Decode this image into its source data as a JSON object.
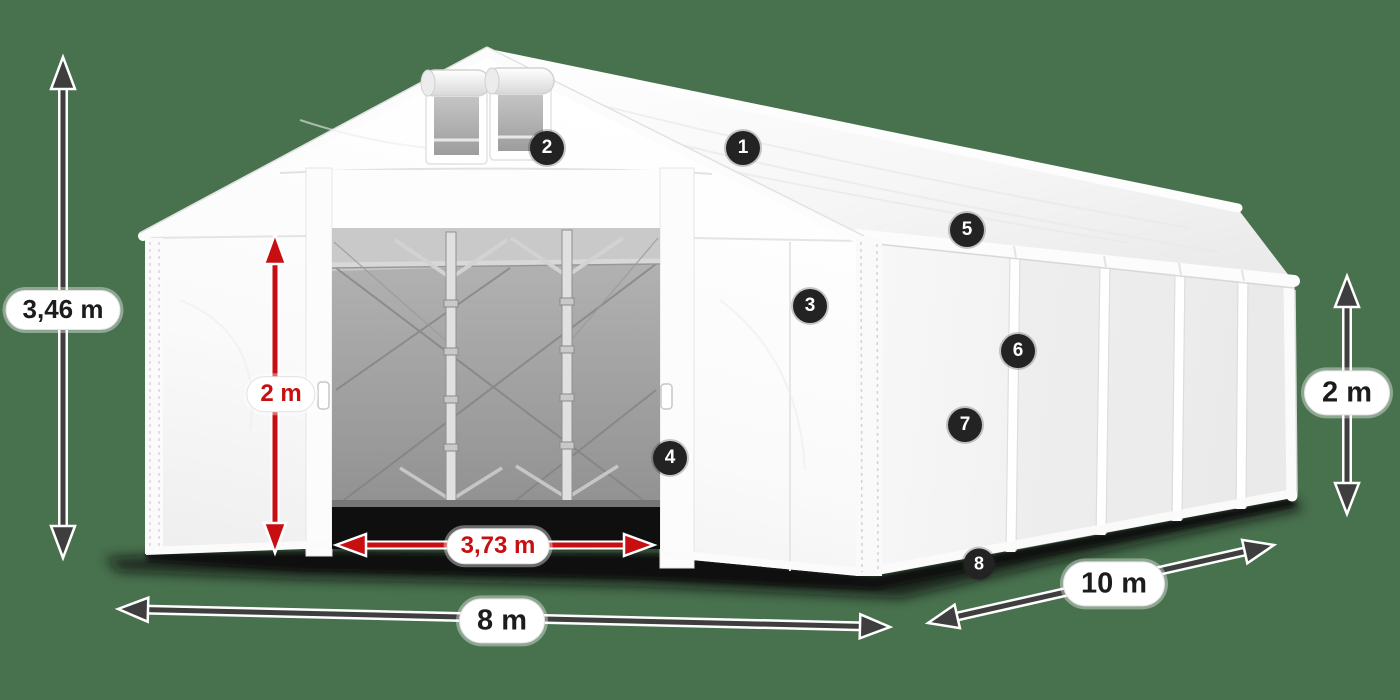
{
  "diagram": {
    "title": "tent-dimensions-diagram",
    "background_color": "#48714e",
    "dimensions": {
      "total_height": "3,46 m",
      "door_height": "2 m",
      "door_width": "3,73 m",
      "front_width": "8 m",
      "side_length": "10 m",
      "side_wall_height": "2 m"
    },
    "badges": [
      {
        "label": "1"
      },
      {
        "label": "2"
      },
      {
        "label": "3"
      },
      {
        "label": "4"
      },
      {
        "label": "5"
      },
      {
        "label": "6"
      },
      {
        "label": "7"
      },
      {
        "label": "8"
      }
    ],
    "colors": {
      "accent_red": "#c70f12",
      "arrow_dark": "#3e3e3e",
      "badge_bg": "#232323",
      "tent_white": "#ffffff",
      "interior_gray": "#a3a3a3",
      "pill_bg": "#ffffff"
    }
  }
}
